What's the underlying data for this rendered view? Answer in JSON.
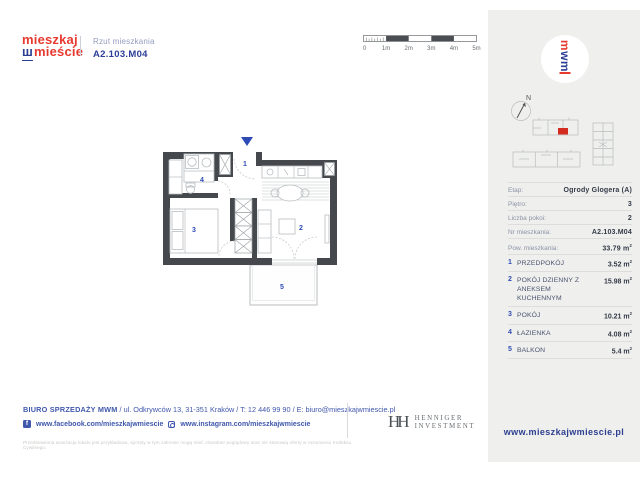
{
  "colors": {
    "brand_red": "#e6392f",
    "brand_blue": "#2d3f92",
    "room_number_blue": "#2d4bb5",
    "wall_gray": "#45494d",
    "sidebar_bg": "#efefed",
    "footer_blue": "#4058ac",
    "highlight_unit_red": "#d42b20"
  },
  "header": {
    "logo_line1": "mieszkaj",
    "logo_w": "ш",
    "logo_line2": "mieście",
    "doc_type": "Rzut mieszkania",
    "unit_id": "A2.103.M04"
  },
  "scalebar": {
    "labels": [
      "0",
      "1m",
      "2m",
      "3m",
      "4m",
      "5m"
    ]
  },
  "plan": {
    "labels": [
      "1",
      "2",
      "3",
      "4",
      "5"
    ],
    "entrance_marker": "entrance-arrow-down"
  },
  "sidebar": {
    "logo_text": {
      "first": "m",
      "rest": "wm"
    },
    "compass_label": "N",
    "details": [
      {
        "label": "Etap:",
        "value": "Ogrody Glogera (A)"
      },
      {
        "label": "Piętro:",
        "value": "3"
      },
      {
        "label": "Liczba pokoi:",
        "value": "2"
      },
      {
        "label": "Nr mieszkania:",
        "value": "A2.103.M04"
      },
      {
        "label": "Pow. mieszkania:",
        "value": "33.79"
      }
    ],
    "rooms": [
      {
        "num": "1",
        "name": "PRZEDPOKÓJ",
        "area": "3.52"
      },
      {
        "num": "2",
        "name": "POKÓJ DZIENNY Z",
        "name2": "ANEKSEM KUCHENNYM",
        "area": "15.98"
      },
      {
        "num": "3",
        "name": "POKÓJ",
        "area": "10.21"
      },
      {
        "num": "4",
        "name": "ŁAZIENKA",
        "area": "4.08"
      },
      {
        "num": "5",
        "name": "BALKON",
        "area": "5.4"
      }
    ],
    "website": "www.mieszkajwmiescie.pl"
  },
  "units": {
    "m": "m",
    "sup": "2"
  },
  "footer": {
    "office_label": "BIURO SPRZEDAŻY MWM",
    "office_rest": " / ul. Odkrywców 13, 31-351 Kraków / T: 12 446 99 90 / E: biuro@mieszkajwmiescie.pl",
    "facebook_url": "www.facebook.com/mieszkajwmiescie",
    "instagram_url": "www.instagram.com/mieszkajwmiescie",
    "disclaimer": "Przedstawiona aranżacja lokalu jest przykładowa, sprzęty w tym zakresie mogą mieć charakter poglądowy oraz nie stanowią oferty w rozumieniu Kodeksu Cywilnego.",
    "partner_monogram": "HH",
    "partner_name_line1": "HENNIGER",
    "partner_name_line2": "INVESTMENT"
  },
  "icons": {
    "facebook": "f"
  }
}
